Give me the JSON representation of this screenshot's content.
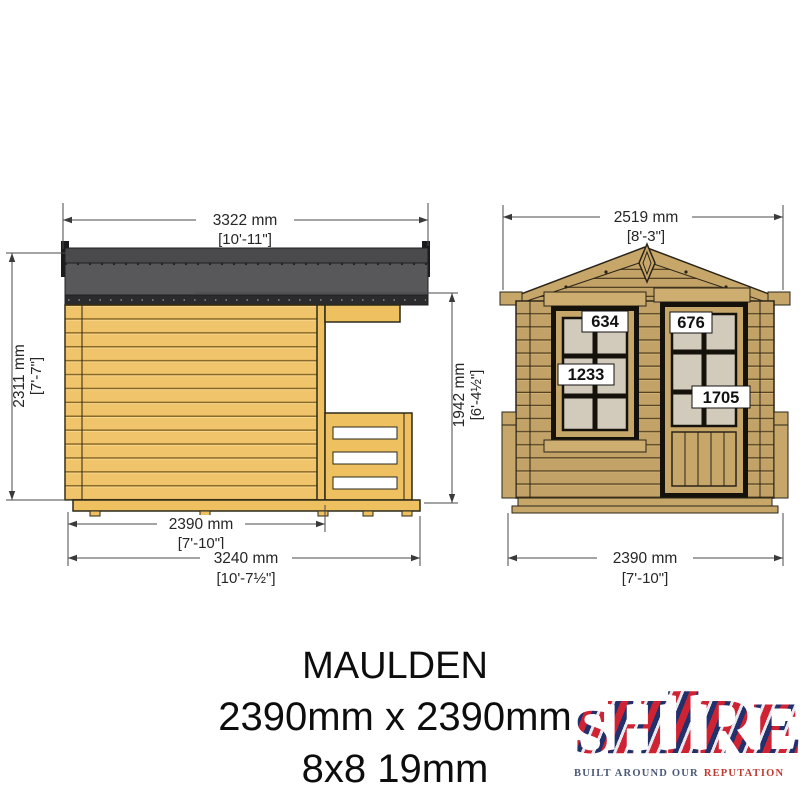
{
  "side_view": {
    "dim_top": {
      "mm": "3322 mm",
      "ft": "[10'-11\"]"
    },
    "dim_left": {
      "mm": "2311 mm",
      "ft": "[7'-7\"]"
    },
    "dim_right": {
      "mm": "1942 mm",
      "ft": "[6'-4½\"]"
    },
    "dim_inner": {
      "mm": "2390 mm",
      "ft": "[7'-10\"]"
    },
    "dim_full": {
      "mm": "3240 mm",
      "ft": "[10'-7½\"]"
    }
  },
  "front_view": {
    "dim_top": {
      "mm": "2519 mm",
      "ft": "[8'-3\"]"
    },
    "dim_bottom": {
      "mm": "2390 mm",
      "ft": "[7'-10\"]"
    },
    "window": {
      "width_label": "634",
      "height_label": "1233"
    },
    "door": {
      "width_label": "676",
      "height_label": "1705"
    }
  },
  "title_block": {
    "product_name": "MAULDEN",
    "size_mm": "2390mm x 2390mm",
    "size_spec": "8x8 19mm"
  },
  "brand": {
    "name": "SHIRE",
    "tagline_left": "BUILT AROUND OUR",
    "tagline_right": "REPUTATION"
  },
  "colors": {
    "side_wall": "#f0c46a",
    "front_wood": "#c2a266",
    "roof_gray": "#58585a",
    "glazing": "#d2cbbc",
    "dimension": "#4a4a4a",
    "tagline_navy": "#4a5878",
    "tagline_red": "#c0392e"
  }
}
